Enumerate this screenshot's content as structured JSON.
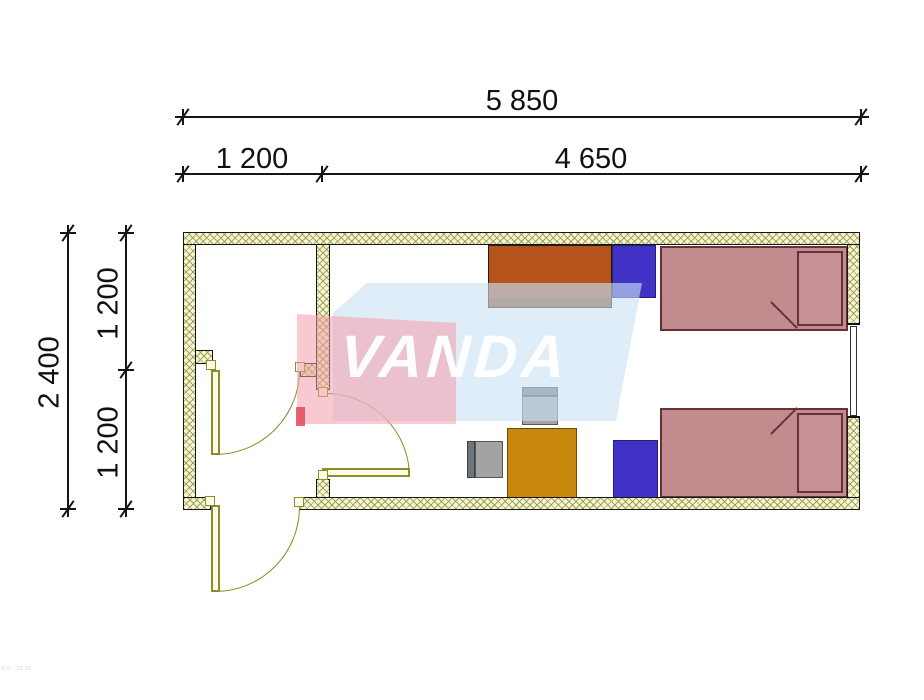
{
  "dimensions": {
    "top_total": "5 850",
    "top_segment_left": "1 200",
    "top_segment_right": "4 650",
    "left_total": "2 400",
    "left_segment_upper": "1 200",
    "left_segment_lower": "1 200"
  },
  "watermark": {
    "text": "VANDA",
    "pink_band": "#f3a9b4",
    "blue_slab": "#cbe2f3",
    "red_accent": "#e04a58"
  },
  "colors": {
    "wall_hatch_fill": "#f7f4d8",
    "wall_hatch_line": "#94983e",
    "wall_outline": "#161616",
    "door_olive": "#8b8d28",
    "bed_fill": "#c28b8d",
    "bed_outline": "#66323a",
    "locker_blue": "#4032c4",
    "cabinet_orange": "#b4531c",
    "table_gold": "#c8880e",
    "chair_gray": "#a3a3a3",
    "chair_back_gray": "#6e757d"
  },
  "footer": {
    "fine_print": "6.0 - 20 20"
  }
}
